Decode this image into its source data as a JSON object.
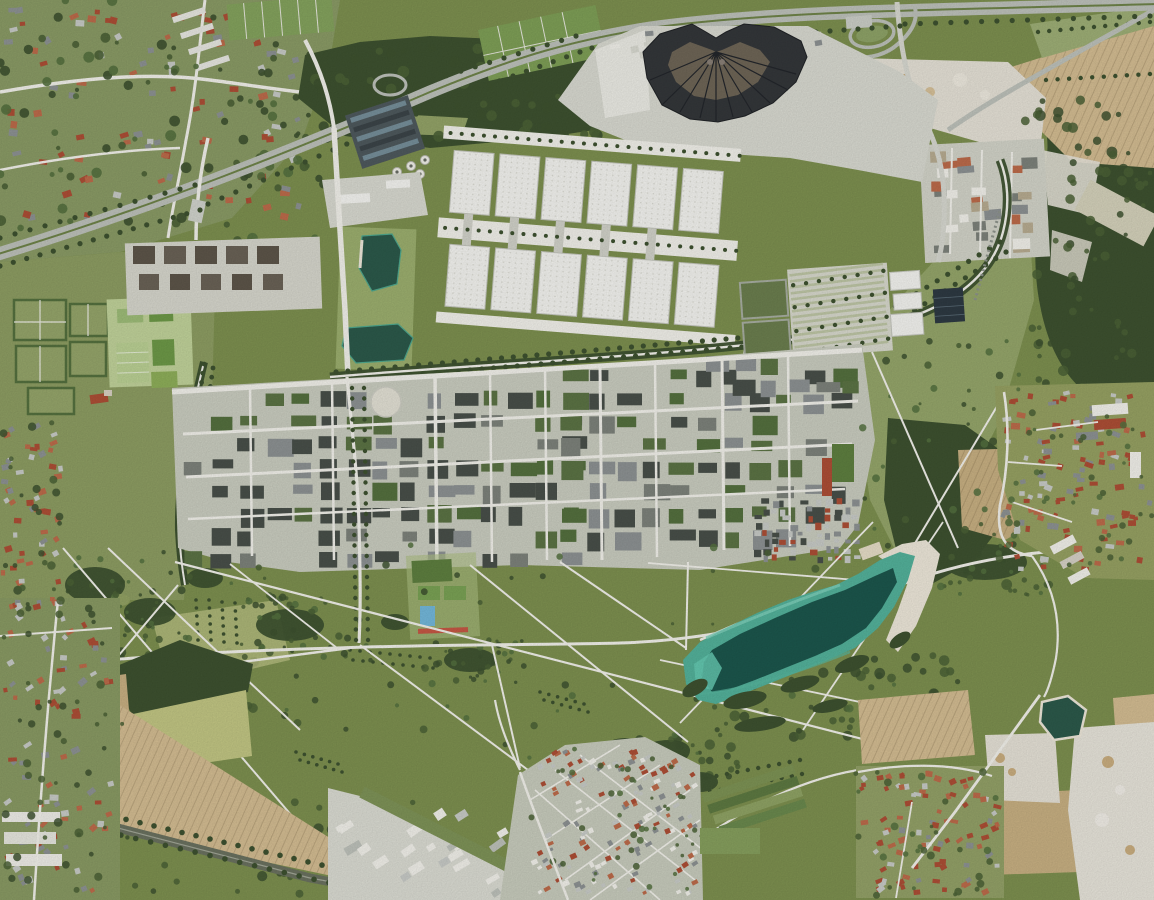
{
  "scene": {
    "kind": "aerial-orthophoto",
    "description": "Vertical aerial photograph of a trade-fair and residential district: two rows of white exhibition halls, a dark fan-shaped hall, dense perimeter-block housing, a large landscaped park crossed by diagonal white paths, a turquoise bathing lake with a sand beach, motorway at top, railway at bottom-left, surrounded by farm fields, woods, gravel pits and villages",
    "width_px": 1154,
    "height_px": 900
  },
  "palette": {
    "park_green": "#7E9150",
    "meadow": "#93A364",
    "meadow_light": "#A6B373",
    "meadow_pale": "#C3C784",
    "west_meadow": "#8E9E63",
    "field_tan": "#D5BE93",
    "field_tan2": "#C9B183",
    "field_pale": "#D6D3BC",
    "gravel": "#E7E3D8",
    "white": "#F3F2EC",
    "pavement": "#DADBD2",
    "urban": "#CBCEC1",
    "hall": "#F5F5F1",
    "hall_edge": "#C5C7BE",
    "fan_dark": "#34373A",
    "fan_inner": "#6F6657",
    "forest": "#3E5230",
    "tree": "#4B6236",
    "hedge": "#55713F",
    "water_deep": "#1C574D",
    "water_teal": "#54B39C",
    "water_light": "#93D7C3",
    "beach": "#EFE9DB",
    "pond": "#2C5A4B",
    "pool": "#74B9DC",
    "track": "#C75845",
    "roof_red": "#AE4F36",
    "roof_orange": "#BE6C4B",
    "roof_gray": "#8E9394",
    "roof_light": "#C9CCC8",
    "block_dark": "#49504A",
    "block_green": "#5C7445",
    "block_gray": "#7E837C",
    "road_gray": "#BFC3BC",
    "rail": "#6B7260",
    "solar": "#2E3A43",
    "tan_unit": "#B9AD92",
    "stripe_green": "#BFC7A6",
    "brown_block": "#5E564A"
  },
  "features": {
    "fan_building": {
      "label": "dark fan-shaped hall with radial roof segments",
      "segments": 10
    },
    "exhibition_halls": {
      "label": "white exhibition halls with skylight grids",
      "rows": 2,
      "halls_per_row": 6
    },
    "lake": {
      "label": "elongated turquoise bathing lake",
      "beach": "white sand strip on north-east shore"
    },
    "ponds": {
      "label": "two dark-green ponds west of the halls and one gravel-pit pond bottom right",
      "count": 3
    },
    "park": {
      "label": "large meadow park criss-crossed by straight white paths",
      "path_lines": 20
    },
    "residential_district": {
      "label": "dense perimeter-block housing with green courtyards and grid streets"
    },
    "motorway": {
      "label": "motorway curving from lower left edge to top right with interchange"
    },
    "railway": {
      "label": "tree-lined railway corridor bottom left"
    },
    "fields": {
      "label": "tan ploughed fields and pale green crop fields"
    },
    "villages": {
      "label": "red-roofed villages",
      "locations": [
        "north-west",
        "bottom-centre",
        "bottom-right",
        "east"
      ]
    },
    "commercial_area": {
      "label": "small warehouse grid north-east of the halls"
    },
    "parking": {
      "label": "striped grass parking rows east of the halls"
    },
    "sports": {
      "label": "sports pitches, blue pool and red running strip"
    },
    "gravel_pits": {
      "label": "white gravel pits top right and bottom right"
    }
  },
  "generators": {
    "nw_houses": {
      "kind": "houses",
      "x": 2,
      "y": 2,
      "w": 300,
      "h": 220,
      "n": 100,
      "seed": 11,
      "minw": 5,
      "maxw": 10,
      "minh": 4,
      "maxh": 7,
      "angle": -8,
      "jitter": 50,
      "colors": [
        "roof_red",
        "roof_orange",
        "roof_gray",
        "roof_light",
        "roof_red"
      ],
      "item": "house"
    },
    "nw_trees": {
      "kind": "trees",
      "seed": 12,
      "rmin": 2,
      "rmax": 5.5,
      "opacity": 0.9,
      "colors": [
        "forest",
        "tree",
        "hedge"
      ],
      "areas": [
        {
          "x": 0,
          "y": 0,
          "w": 320,
          "h": 245,
          "n": 80
        },
        {
          "x": 235,
          "y": 95,
          "w": 115,
          "h": 115,
          "n": 30
        }
      ],
      "item": "tree"
    },
    "north_woods_trees": {
      "kind": "trees",
      "seed": 13,
      "rmin": 2.5,
      "rmax": 6,
      "opacity": 0.9,
      "colors": [
        "forest",
        "tree"
      ],
      "areas": [
        {
          "x": 300,
          "y": 48,
          "w": 330,
          "h": 92,
          "n": 70
        }
      ],
      "item": "tree"
    },
    "apron_structures": {
      "kind": "houses",
      "x": 598,
      "y": 30,
      "w": 240,
      "h": 32,
      "n": 18,
      "seed": 14,
      "minw": 6,
      "maxw": 14,
      "minh": 4,
      "maxh": 8,
      "angle": -8,
      "jitter": 10,
      "colors": [
        "white",
        "pavement",
        "roof_gray",
        "white"
      ],
      "item": "service-building"
    },
    "commercial_units": {
      "kind": "houses",
      "x": 928,
      "y": 146,
      "w": 112,
      "h": 108,
      "n": 26,
      "seed": 15,
      "minw": 9,
      "maxw": 18,
      "minh": 6,
      "maxh": 12,
      "angle": -3,
      "jitter": 6,
      "colors": [
        "white",
        "tan_unit",
        "block_gray",
        "roof_orange",
        "roof_gray",
        "white"
      ],
      "item": "warehouse"
    },
    "res_blocks": {
      "kind": "blocks",
      "seed": 21,
      "cellw": 27,
      "cellh": 23,
      "skip": 0.3,
      "bw": 19,
      "bh": 13,
      "colors": [
        "block_dark",
        "block_green",
        "block_dark",
        "roof_gray",
        "hedge",
        "block_gray"
      ],
      "regions": [
        {
          "x": 183,
          "y": 390,
          "w": 390,
          "h": 162
        },
        {
          "x": 560,
          "y": 368,
          "w": 295,
          "h": 180
        },
        {
          "x": 705,
          "y": 356,
          "w": 148,
          "h": 40
        }
      ],
      "item": "apartment-block"
    },
    "rowhouses": {
      "kind": "blocks",
      "seed": 22,
      "cellw": 9,
      "cellh": 8,
      "skip": 0.25,
      "bw": 6,
      "bh": 5,
      "colors": [
        "roof_gray",
        "roof_red",
        "roof_light",
        "block_dark"
      ],
      "regions": [
        {
          "x": 752,
          "y": 498,
          "w": 108,
          "h": 64
        }
      ],
      "item": "row-house"
    },
    "park_tree_texture": {
      "kind": "trees",
      "seed": 23,
      "rmin": 1.5,
      "rmax": 4,
      "opacity": 0.85,
      "colors": [
        "forest",
        "tree",
        "hedge"
      ],
      "areas": [
        {
          "x": 60,
          "y": 552,
          "w": 130,
          "h": 92,
          "n": 50
        },
        {
          "x": 240,
          "y": 595,
          "w": 115,
          "h": 62,
          "n": 40
        },
        {
          "x": 428,
          "y": 638,
          "w": 105,
          "h": 48,
          "n": 28
        },
        {
          "x": 100,
          "y": 545,
          "w": 800,
          "h": 200,
          "n": 70
        },
        {
          "x": 862,
          "y": 340,
          "w": 165,
          "h": 225,
          "n": 40
        }
      ],
      "item": "tree"
    },
    "forest_textures": {
      "kind": "trees",
      "seed": 24,
      "rmin": 2,
      "rmax": 5.5,
      "opacity": 0.85,
      "colors": [
        "forest",
        "tree"
      ],
      "areas": [
        {
          "x": 1025,
          "y": 95,
          "w": 125,
          "h": 320,
          "n": 90
        },
        {
          "x": 892,
          "y": 420,
          "w": 115,
          "h": 165,
          "n": 55
        },
        {
          "x": 690,
          "y": 655,
          "w": 270,
          "h": 82,
          "n": 60
        },
        {
          "x": 600,
          "y": 735,
          "w": 145,
          "h": 60,
          "n": 40
        },
        {
          "x": 0,
          "y": 795,
          "w": 420,
          "h": 100,
          "n": 45
        },
        {
          "x": 107,
          "y": 650,
          "w": 148,
          "h": 72,
          "n": 30
        }
      ],
      "item": "tree"
    },
    "village_center_houses": {
      "kind": "houses",
      "x": 530,
      "y": 748,
      "w": 170,
      "h": 148,
      "n": 150,
      "seed": 31,
      "minw": 3.5,
      "maxw": 7,
      "minh": 3,
      "maxh": 5.5,
      "angle": -28,
      "jitter": 14,
      "colors": [
        "roof_red",
        "roof_gray",
        "roof_light",
        "roof_orange",
        "white"
      ],
      "item": "house"
    },
    "village_center_trees": {
      "kind": "trees",
      "seed": 32,
      "rmin": 1.5,
      "rmax": 3.5,
      "opacity": 0.85,
      "colors": [
        "tree",
        "hedge"
      ],
      "areas": [
        {
          "x": 528,
          "y": 745,
          "w": 178,
          "h": 152,
          "n": 45
        }
      ],
      "item": "tree"
    },
    "village_br_houses": {
      "kind": "houses",
      "x": 858,
      "y": 770,
      "w": 145,
      "h": 126,
      "n": 90,
      "seed": 33,
      "minw": 4,
      "maxw": 8,
      "minh": 3.5,
      "maxh": 6,
      "angle": -10,
      "jitter": 60,
      "colors": [
        "roof_red",
        "roof_gray",
        "roof_orange",
        "roof_light",
        "roof_red"
      ],
      "item": "house"
    },
    "village_e_houses": {
      "kind": "houses",
      "x": 1000,
      "y": 390,
      "w": 152,
      "h": 182,
      "n": 115,
      "seed": 34,
      "minw": 4,
      "maxw": 9,
      "minh": 3.5,
      "maxh": 6.5,
      "angle": 3,
      "jitter": 40,
      "colors": [
        "roof_red",
        "roof_red",
        "roof_orange",
        "roof_gray",
        "roof_light"
      ],
      "item": "house"
    },
    "village_e_trees": {
      "kind": "trees",
      "seed": 35,
      "rmin": 1.5,
      "rmax": 3.5,
      "opacity": 0.85,
      "colors": [
        "tree",
        "hedge"
      ],
      "areas": [
        {
          "x": 998,
          "y": 388,
          "w": 156,
          "h": 186,
          "n": 40
        }
      ],
      "item": "tree"
    },
    "sw_houses": {
      "kind": "houses",
      "x": 2,
      "y": 600,
      "w": 112,
      "h": 296,
      "n": 85,
      "seed": 36,
      "minw": 4,
      "maxw": 9,
      "minh": 3.5,
      "maxh": 6.5,
      "angle": -20,
      "jitter": 50,
      "colors": [
        "roof_red",
        "roof_gray",
        "roof_orange",
        "roof_light"
      ],
      "item": "house"
    },
    "westedge_houses": {
      "kind": "houses",
      "x": 0,
      "y": 420,
      "w": 64,
      "h": 190,
      "n": 55,
      "seed": 37,
      "minw": 4,
      "maxw": 8,
      "minh": 3.5,
      "maxh": 6,
      "angle": -10,
      "jitter": 50,
      "colors": [
        "roof_red",
        "roof_gray",
        "roof_light",
        "roof_orange"
      ],
      "item": "house"
    },
    "sw_trees": {
      "kind": "trees",
      "seed": 38,
      "rmin": 1.8,
      "rmax": 4.5,
      "opacity": 0.85,
      "colors": [
        "forest",
        "tree"
      ],
      "areas": [
        {
          "x": 0,
          "y": 598,
          "w": 125,
          "h": 300,
          "n": 45
        },
        {
          "x": 0,
          "y": 415,
          "w": 70,
          "h": 200,
          "n": 25
        }
      ],
      "item": "tree"
    },
    "industrial_units": {
      "kind": "houses",
      "x": 333,
      "y": 800,
      "w": 205,
      "h": 96,
      "n": 24,
      "seed": 39,
      "minw": 8,
      "maxw": 18,
      "minh": 5,
      "maxh": 10,
      "angle": -33,
      "jitter": 6,
      "colors": [
        "white",
        "roof_light",
        "road_gray",
        "white"
      ],
      "item": "industrial-building"
    },
    "br_trees": {
      "kind": "trees",
      "seed": 40,
      "rmin": 1.8,
      "rmax": 4,
      "opacity": 0.85,
      "colors": [
        "tree",
        "hedge"
      ],
      "areas": [
        {
          "x": 852,
          "y": 765,
          "w": 150,
          "h": 135,
          "n": 30
        },
        {
          "x": 940,
          "y": 528,
          "w": 112,
          "h": 70,
          "n": 25
        }
      ],
      "item": "tree"
    },
    "parking_rows": {
      "kind": "rows",
      "r": 2.2,
      "color": "forest",
      "lines": [
        [
          795,
          282,
          886,
          274,
          7
        ],
        [
          795,
          304,
          886,
          296,
          7
        ],
        [
          795,
          328,
          886,
          320,
          7
        ],
        [
          795,
          350,
          886,
          342,
          7
        ]
      ],
      "item": "tree"
    },
    "spine_trees": {
      "kind": "rows",
      "r": 2,
      "color": "forest",
      "lines": [
        [
          450,
          133,
          740,
          133,
          26
        ],
        [
          452,
          228,
          744,
          228,
          26
        ]
      ],
      "item": "tree"
    },
    "boulevard_trees": {
      "kind": "rows",
      "r": 2.6,
      "color": "forest",
      "lines": [
        [
          336,
          372,
          856,
          328,
          44
        ],
        [
          340,
          381,
          860,
          337,
          44
        ],
        [
          864,
          326,
          1000,
          242,
          13
        ],
        [
          874,
          336,
          1006,
          252,
          13
        ]
      ],
      "item": "tree"
    },
    "avenue_trees": {
      "kind": "rows",
      "r": 2.2,
      "color": "forest",
      "lines": [
        [
          352,
          388,
          356,
          640,
          24
        ],
        [
          364,
          388,
          368,
          640,
          24
        ]
      ],
      "item": "tree"
    },
    "promenade_trees": {
      "kind": "rows",
      "r": 2.4,
      "color": "forest",
      "lines": [
        [
          204,
          364,
          182,
          530,
          18
        ],
        [
          213,
          368,
          190,
          534,
          18
        ]
      ],
      "item": "tree"
    },
    "park_tree_rows": {
      "kind": "rows",
      "r": 1.8,
      "color": "forest",
      "lines": [
        [
          196,
          600,
          198,
          640,
          5
        ],
        [
          209,
          600,
          211,
          640,
          5
        ],
        [
          222,
          602,
          224,
          642,
          5
        ],
        [
          235,
          603,
          237,
          643,
          5
        ],
        [
          350,
          650,
          430,
          658,
          8
        ],
        [
          353,
          660,
          433,
          668,
          8
        ],
        [
          540,
          692,
          584,
          704,
          5
        ],
        [
          544,
          700,
          588,
          712,
          5
        ],
        [
          296,
          752,
          338,
          764,
          5
        ],
        [
          300,
          760,
          342,
          772,
          5
        ]
      ],
      "item": "tree"
    },
    "highway_trees": {
      "kind": "rows",
      "r": 2.6,
      "color": "forest",
      "lines": [
        [
          0,
          266,
          200,
          210,
          15
        ],
        [
          208,
          204,
          430,
          108,
          16
        ],
        [
          446,
          100,
          580,
          52,
          10
        ],
        [
          592,
          48,
          900,
          26,
          22
        ],
        [
          905,
          24,
          1150,
          16,
          16
        ],
        [
          0,
          238,
          195,
          185,
          13
        ],
        [
          432,
          80,
          576,
          36,
          10
        ]
      ],
      "item": "tree"
    },
    "rail_trees": {
      "kind": "rows",
      "r": 2.8,
      "color": "forest",
      "lines": [
        [
          0,
          790,
          420,
          888,
          30
        ],
        [
          2,
          808,
          418,
          903,
          28
        ]
      ],
      "item": "tree"
    },
    "hedge_rows": {
      "kind": "rows",
      "r": 2.2,
      "color": "forest",
      "lines": [
        [
          1038,
          32,
          1150,
          22,
          10
        ],
        [
          1046,
          80,
          1150,
          74,
          9
        ],
        [
          706,
          778,
          800,
          760,
          9
        ],
        [
          710,
          792,
          802,
          774,
          9
        ]
      ],
      "item": "tree"
    },
    "parking_stripes": {
      "kind": "stripes",
      "x": 792,
      "y": 272,
      "w": 94,
      "h": 80,
      "gap": 6,
      "slope": -5,
      "width": 2.6,
      "color": "stripe_green"
    }
  }
}
